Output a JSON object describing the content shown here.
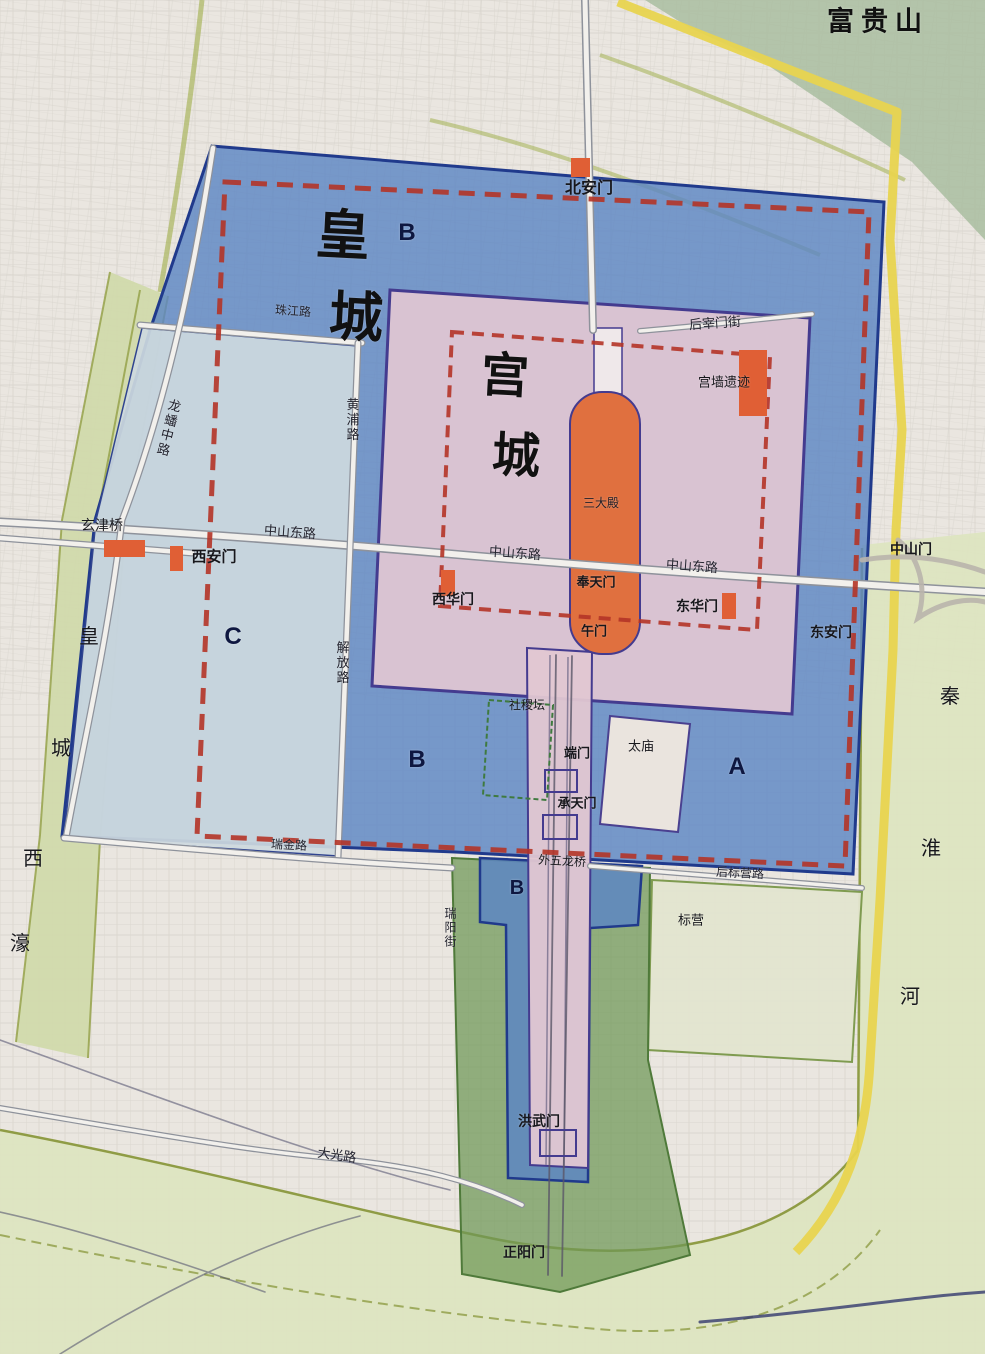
{
  "labels": {
    "fuguishan": "富贵山",
    "beianmen": "北安门",
    "zhujiang_road": "珠江路",
    "huangpu_road": "黄浦路",
    "longpan_road": "龙蟠中路",
    "xuanjin_bridge": "玄津桥",
    "xian_gate": "西安门",
    "zhongshan_east_road": "中山东路",
    "jiefang_road": "解放路",
    "houzaimen_street": "后宰门街",
    "gongqiang_ruins": "宫墙遗迹",
    "sandadian": "三大殿",
    "fengtian_gate": "奉天门",
    "wu_gate": "午门",
    "xihua_gate": "西华门",
    "donghua_gate": "东华门",
    "dongan_gate": "东安门",
    "zhongshan_gate": "中山门",
    "sheji_altar": "社稷坛",
    "duan_gate": "端门",
    "taimiao": "太庙",
    "chengtian_gate": "承天门",
    "ruijin_road": "瑞金路",
    "waiwulong_bridge": "外五龙桥",
    "houbiaoying_road": "后标营路",
    "biaoying": "标营",
    "ruiyang_street": "瑞阳街",
    "hongwu_gate": "洪武门",
    "daguang_road": "大光路",
    "zhengyang_gate": "正阳门"
  },
  "zones": {
    "top_b": "B",
    "mid_b": "B",
    "low_b": "B",
    "a": "A",
    "c": "C"
  },
  "vertical": {
    "city_chars": [
      "皇",
      "城"
    ],
    "palace_chars": [
      "宫",
      "城"
    ],
    "moat_chars": [
      "皇",
      "城",
      "西",
      "濠"
    ],
    "river_chars": [
      "秦",
      "淮",
      "河"
    ]
  },
  "colors": {
    "paper": "#eae6e0",
    "zone_blue": "#5d86c3",
    "zone_blue_border": "#203a8c",
    "zone_light_blue": "#cdd9de",
    "zone_pink": "#e2c7d2",
    "zone_pink_border": "#443b8f",
    "zone_green": "#6d9755",
    "pale_green_block": "#e3e5cf",
    "axis_orange": "#e0703f",
    "marker_orange": "#e05f35",
    "dashed_red": "#b43427",
    "wall_yellow": "#e8d44f",
    "moat_green": "#cfd9a8",
    "road_fill": "#f2f0ec"
  }
}
